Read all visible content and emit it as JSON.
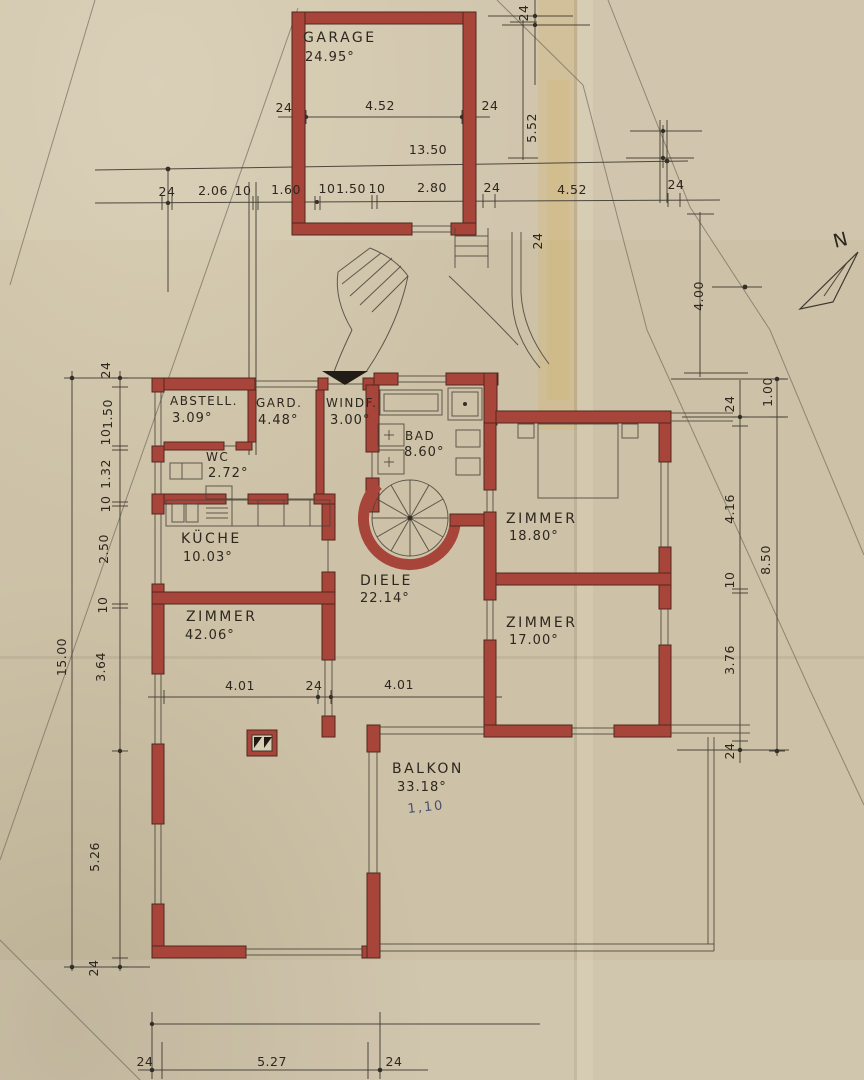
{
  "meta": {
    "kind": "scanned architectural floor plan",
    "language": "de"
  },
  "colors": {
    "paper": "#cdc2a7",
    "wall_red": "#a8453a",
    "ink": "#2d271f",
    "pencil": "#4a443b",
    "note_blue": "#49506b"
  },
  "north": {
    "label": "N"
  },
  "rooms": {
    "garage": {
      "name": "GARAGE",
      "area": "24.95°"
    },
    "abstell": {
      "name": "ABSTELL.",
      "area": "3.09°"
    },
    "gard": {
      "name": "GARD.",
      "area": "4.48°"
    },
    "windf": {
      "name": "WINDF.",
      "area": "3.00°"
    },
    "bad": {
      "name": "BAD",
      "area": "8.60°"
    },
    "wc": {
      "name": "WC",
      "area": "2.72°"
    },
    "kueche": {
      "name": "KÜCHE",
      "area": "10.03°"
    },
    "zimmer_links": {
      "name": "ZIMMER",
      "area": "42.06°"
    },
    "diele": {
      "name": "DIELE",
      "area": "22.14°"
    },
    "zimmer_no": {
      "name": "ZIMMER",
      "area": "18.80°"
    },
    "zimmer_so": {
      "name": "ZIMMER",
      "area": "17.00°"
    },
    "balkon": {
      "name": "BALKON",
      "area": "33.18°",
      "note": "1,10"
    }
  },
  "dims": {
    "garage_row1": [
      "24",
      "4.52",
      "24"
    ],
    "garage_13_50": "13.50",
    "garage_height": "5.52",
    "corner_24": "24",
    "stair_24": "24",
    "right_4_00": "4.00",
    "top_row": [
      "24",
      "2.06",
      "10",
      "1.60",
      "10",
      "1.50",
      "10",
      "2.80",
      "24",
      "4.52",
      "24"
    ],
    "left_col": [
      "24",
      "1.50",
      "10",
      "1.32",
      "10",
      "2.50",
      "10",
      "3.64",
      "5.26",
      "24"
    ],
    "left_total": "15.00",
    "right_col": [
      "24",
      "4.16",
      "10",
      "3.76",
      "24"
    ],
    "right_outer": [
      "1.00",
      "8.50"
    ],
    "mid_row": [
      "4.01",
      "24",
      "4.01"
    ],
    "bottom_row": [
      "24",
      "5.27",
      "24"
    ]
  }
}
